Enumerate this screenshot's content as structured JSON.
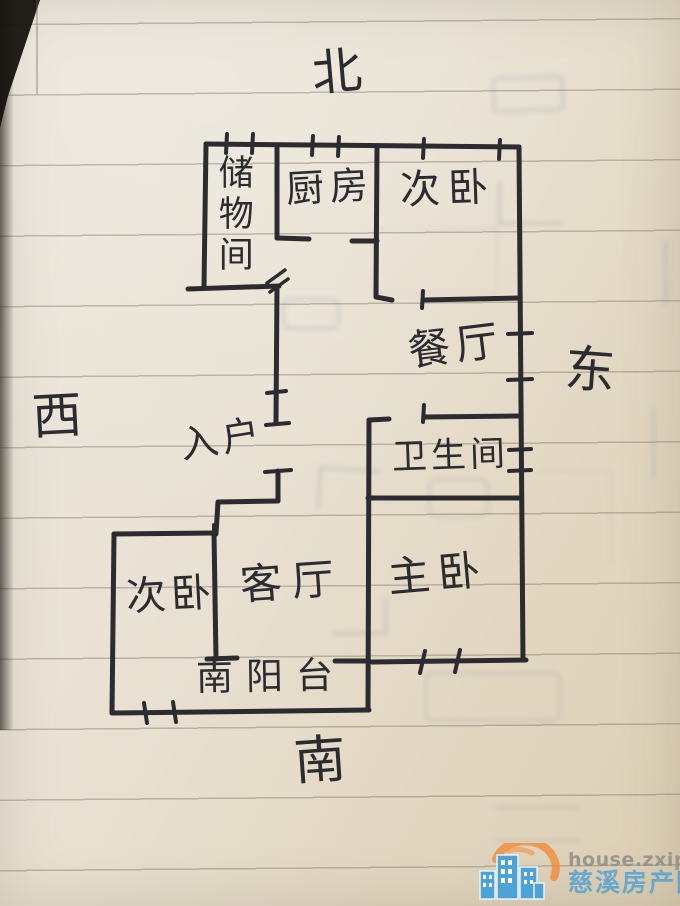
{
  "ink_color": "#2b2b30",
  "paper": {
    "base": "#e7e0d2",
    "line_color": "rgba(122,114,101,0.42)"
  },
  "compass": {
    "north": "北",
    "south": "南",
    "east": "东",
    "west": "西"
  },
  "floorplan": {
    "rooms": [
      {
        "id": "storage",
        "label": "储物间"
      },
      {
        "id": "kitchen",
        "label": "厨房"
      },
      {
        "id": "bedroom-north",
        "label": "次卧"
      },
      {
        "id": "dining",
        "label": "餐厅"
      },
      {
        "id": "bathroom",
        "label": "卫生间"
      },
      {
        "id": "entry",
        "label": "入户"
      },
      {
        "id": "bedroom-west",
        "label": "次卧"
      },
      {
        "id": "living",
        "label": "客厅"
      },
      {
        "id": "master-bedroom",
        "label": "主卧"
      },
      {
        "id": "balcony",
        "label": "南阳台"
      }
    ]
  },
  "watermark": {
    "url": "house.zxip.com",
    "site_name": "慈溪房产网",
    "colors": {
      "url_text": "#94908a",
      "site_text": "#4da0d6",
      "logo_building": "#4da3d6",
      "logo_sun": "#f09040"
    }
  }
}
